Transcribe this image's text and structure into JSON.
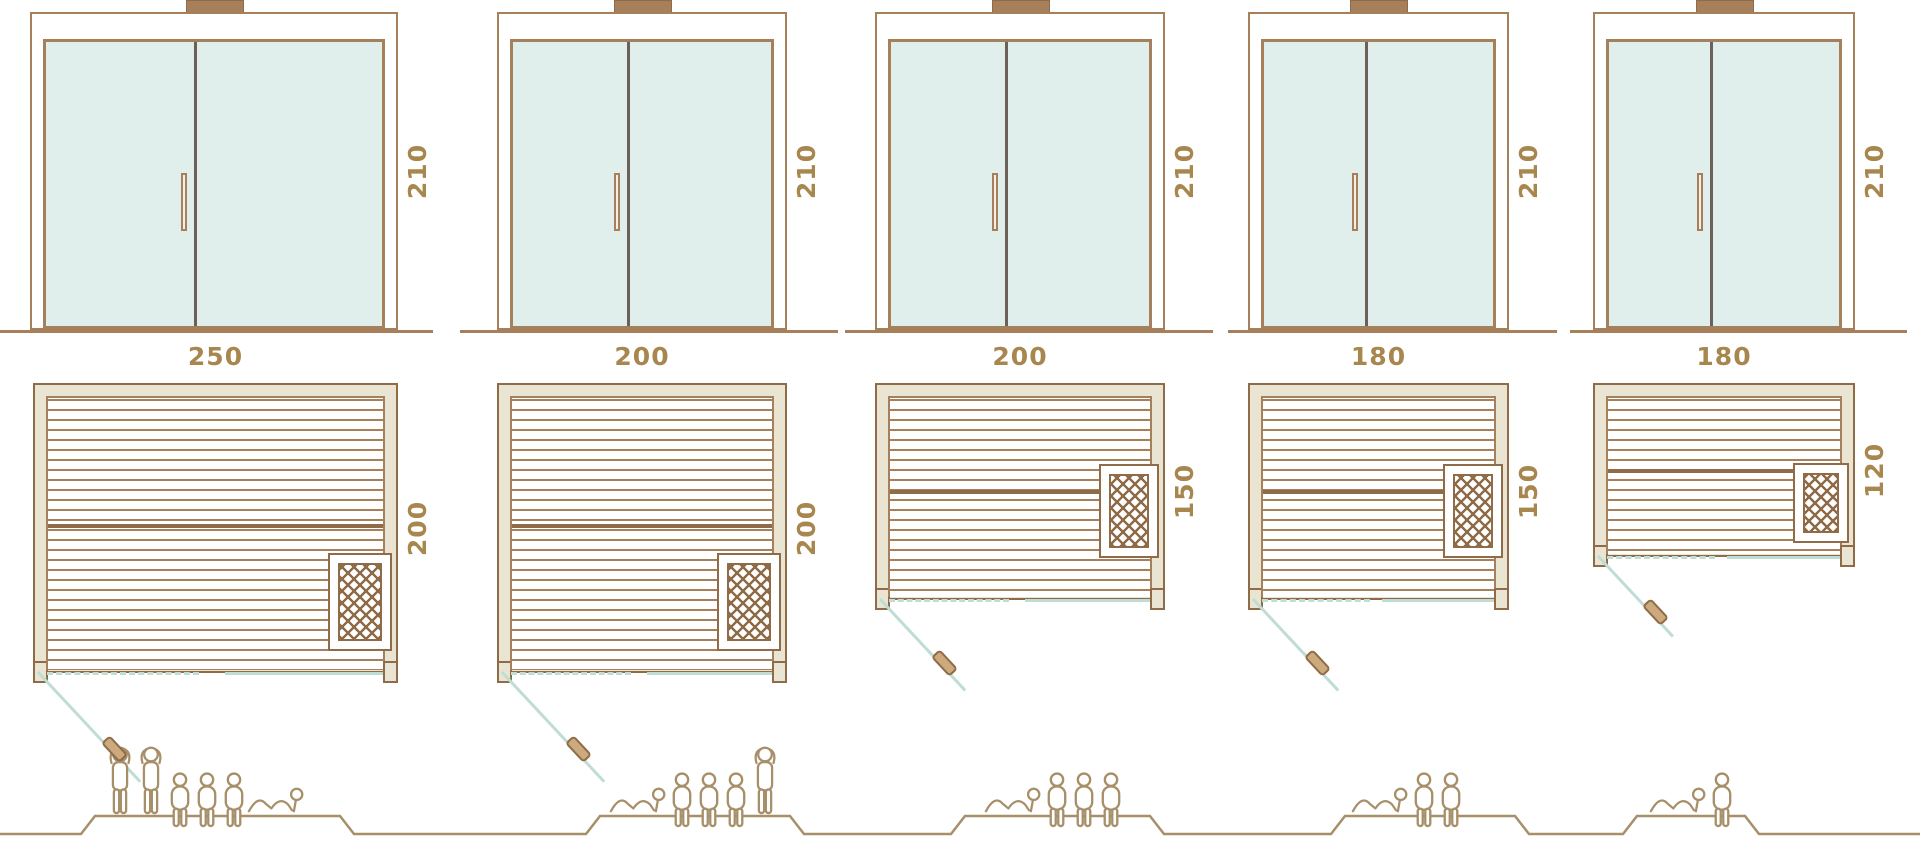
{
  "page": {
    "title": "Sauna size comparison diagram"
  },
  "units": "cm",
  "columns": [
    {
      "name": "sauna-250x200",
      "width_label": "250",
      "height_label": "210",
      "depth_label": "200",
      "capacity": {
        "standing": 2,
        "sitting": 3,
        "lying": 1
      },
      "figures": [
        "standing",
        "standing",
        "sitting",
        "sitting",
        "sitting",
        "lying"
      ]
    },
    {
      "name": "sauna-200x200",
      "width_label": "200",
      "height_label": "210",
      "depth_label": "200",
      "capacity": {
        "standing": 1,
        "sitting": 3,
        "lying": 1
      },
      "figures": [
        "lying",
        "sitting",
        "sitting",
        "sitting",
        "standing"
      ]
    },
    {
      "name": "sauna-200x150",
      "width_label": "200",
      "height_label": "210",
      "depth_label": "150",
      "capacity": {
        "standing": 0,
        "sitting": 3,
        "lying": 1
      },
      "figures": [
        "lying",
        "sitting",
        "sitting",
        "sitting"
      ]
    },
    {
      "name": "sauna-180x150",
      "width_label": "180",
      "height_label": "210",
      "depth_label": "150",
      "capacity": {
        "standing": 0,
        "sitting": 2,
        "lying": 1
      },
      "figures": [
        "lying",
        "sitting",
        "sitting"
      ]
    },
    {
      "name": "sauna-180x120",
      "width_label": "180",
      "height_label": "210",
      "depth_label": "120",
      "capacity": {
        "standing": 0,
        "sitting": 1,
        "lying": 1
      },
      "figures": [
        "lying",
        "sitting"
      ]
    }
  ],
  "icons": {
    "person_standing": "person-standing-icon",
    "person_sitting": "person-sitting-icon",
    "person_lying": "person-lying-icon",
    "heater": "heater-crosshatch-icon",
    "door_swing": "door-swing-line",
    "door_knob": "door-knob-icon",
    "chimney": "roof-vent-icon"
  },
  "colors": {
    "line": "#a5805a",
    "line-dark": "#8f6b47",
    "glass": "#e1efec",
    "divider": "#6b6158",
    "frame-fill": "#e9e5d2",
    "teal": "#bfdcd5",
    "gold": "#a8874f",
    "people": "#a78f69"
  }
}
